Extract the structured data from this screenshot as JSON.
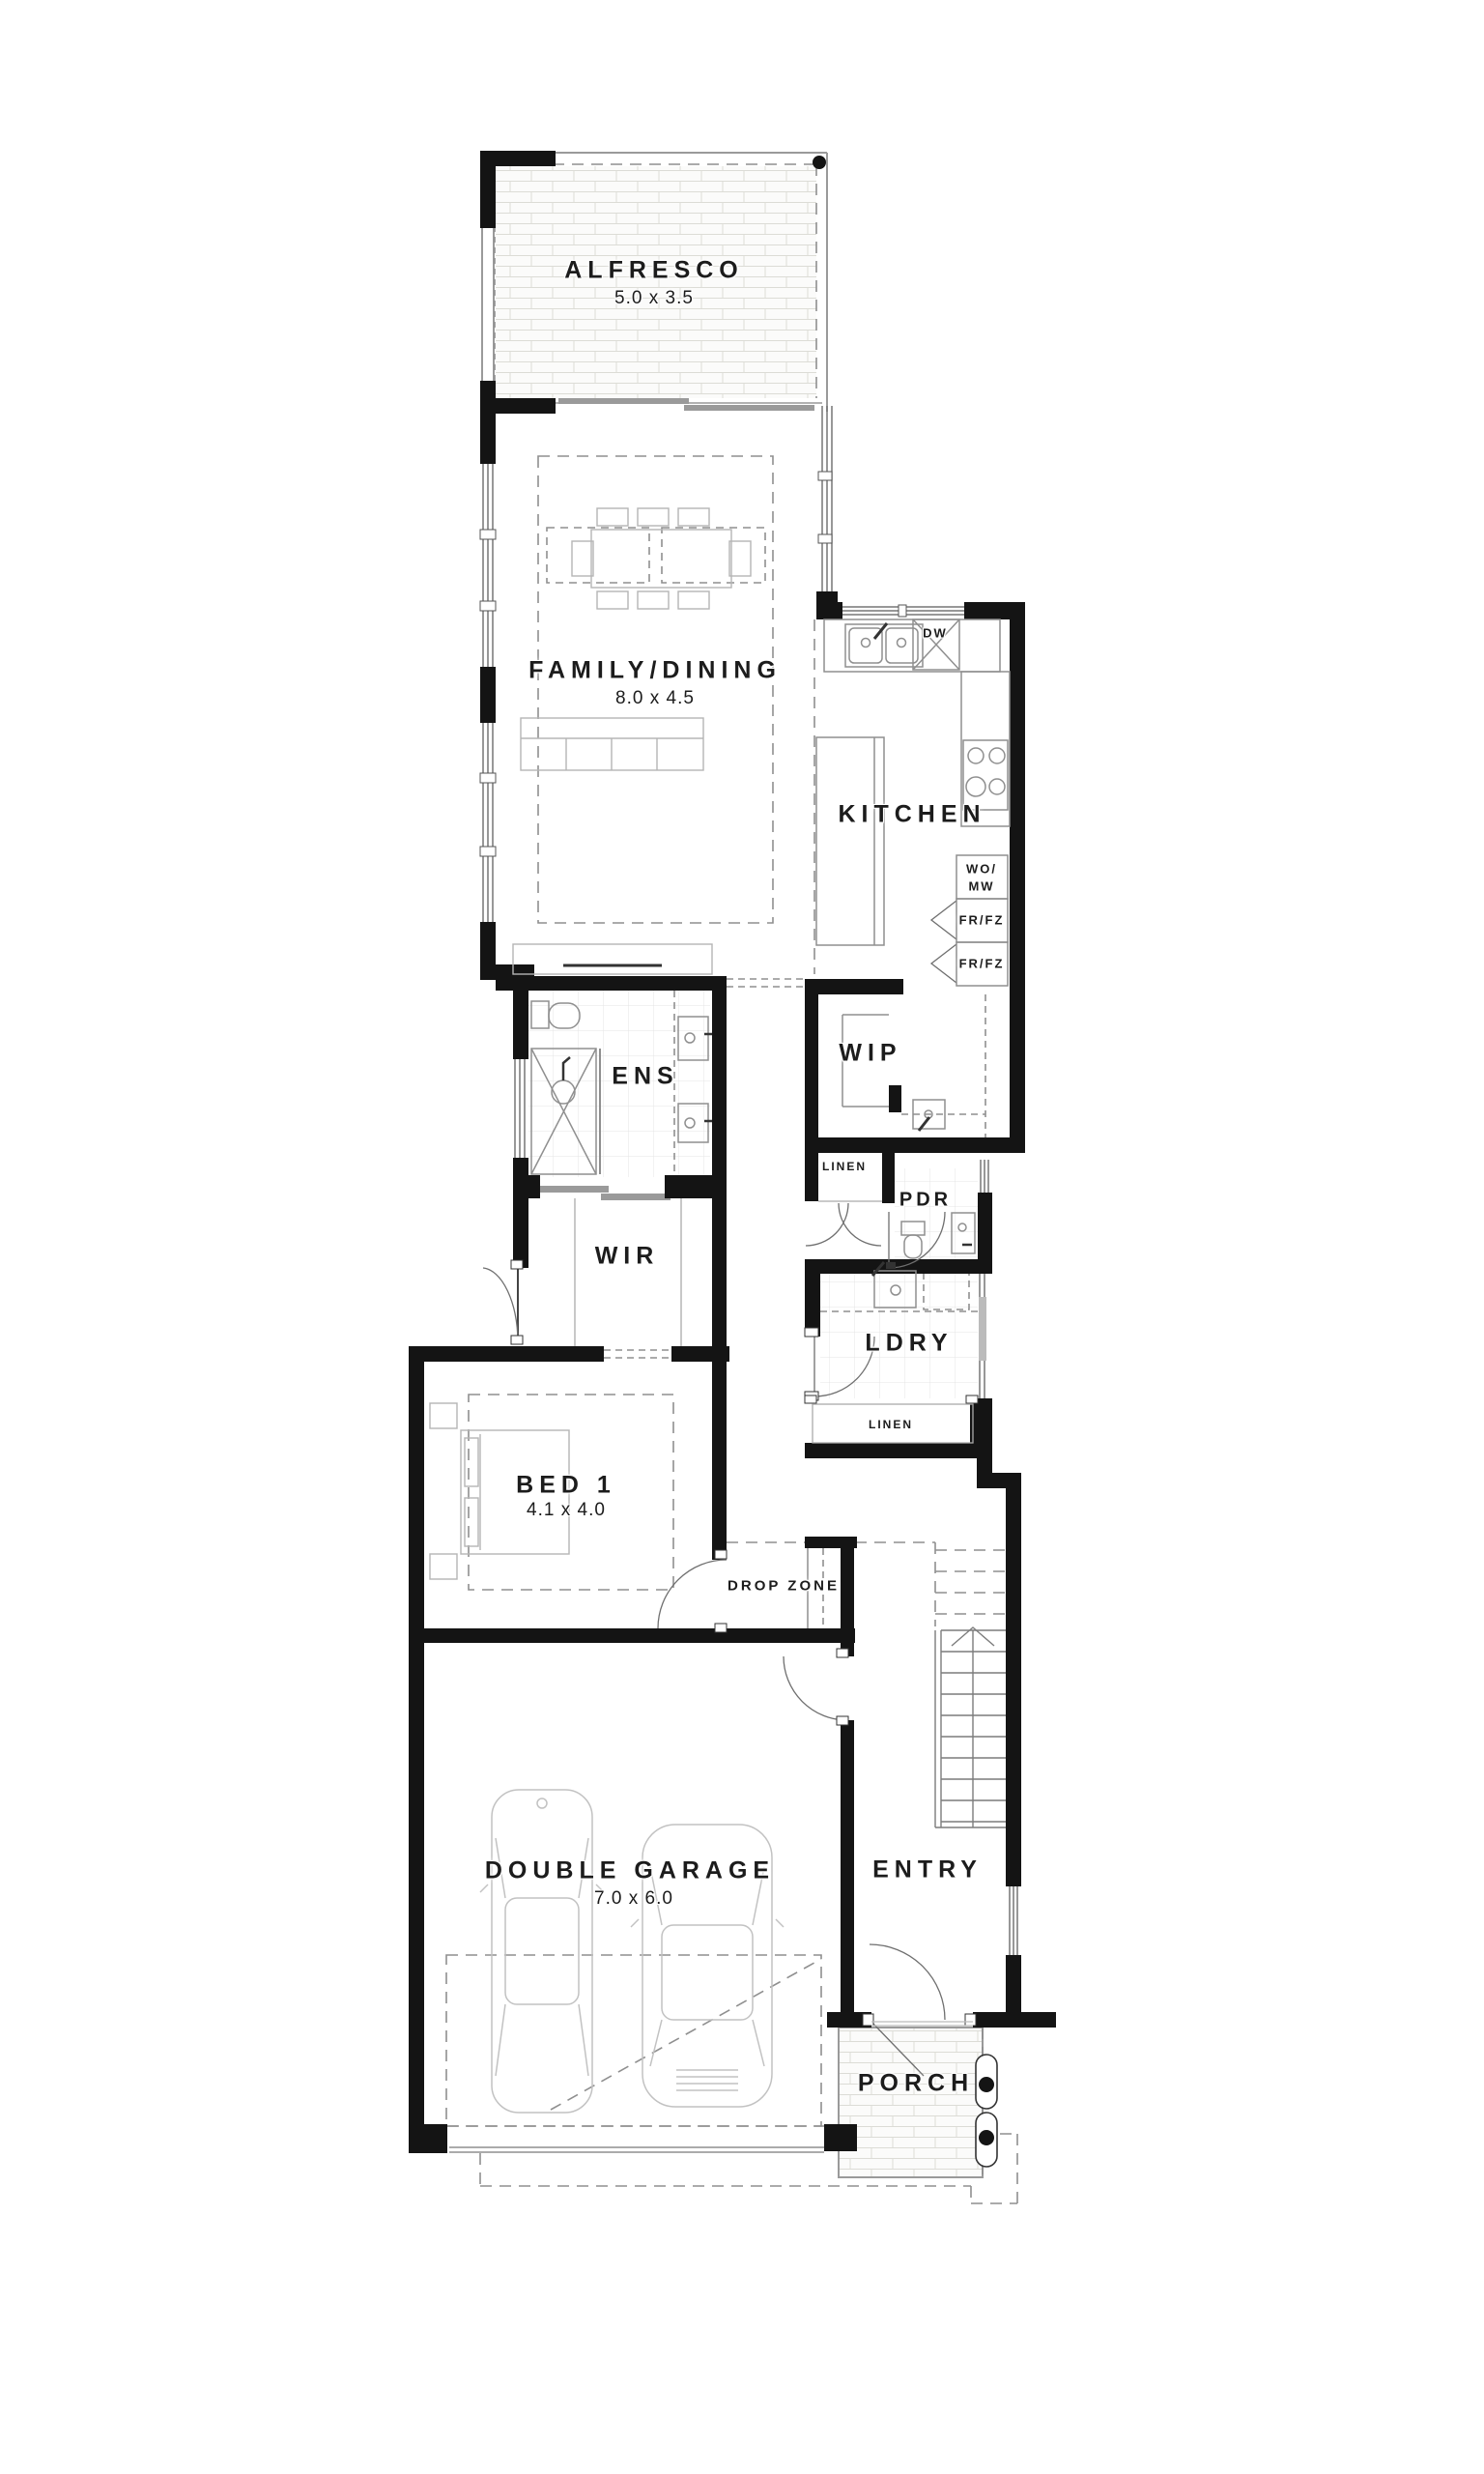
{
  "plan": {
    "rooms": {
      "alfresco": {
        "name": "ALFRESCO",
        "dims": "5.0 x 3.5"
      },
      "family_dining": {
        "name": "FAMILY/DINING",
        "dims": "8.0 x 4.5"
      },
      "kitchen": {
        "name": "KITCHEN"
      },
      "wip": {
        "name": "WIP"
      },
      "ens": {
        "name": "ENS"
      },
      "wir": {
        "name": "WIR"
      },
      "pdr": {
        "name": "PDR"
      },
      "ldry": {
        "name": "LDRY"
      },
      "linen_hall": {
        "name": "LINEN"
      },
      "linen_laundry": {
        "name": "LINEN"
      },
      "bed1": {
        "name": "BED 1",
        "dims": "4.1 x 4.0"
      },
      "drop_zone": {
        "name": "DROP ZONE"
      },
      "double_garage": {
        "name": "DOUBLE GARAGE",
        "dims": "7.0 x 6.0"
      },
      "entry": {
        "name": "ENTRY"
      },
      "porch": {
        "name": "PORCH"
      }
    },
    "appliances": {
      "dishwasher": "DW",
      "wall_oven_microwave_line1": "WO/",
      "wall_oven_microwave_line2": "MW",
      "fridge_freezer_1": "FR/FZ",
      "fridge_freezer_2": "FR/FZ"
    },
    "colors": {
      "wall": "#141414",
      "line": "#8f8f8f",
      "tile": "#e4e4e4",
      "brick": "#dcdcd6",
      "text": "#1c1c1c",
      "background": "#ffffff"
    }
  }
}
